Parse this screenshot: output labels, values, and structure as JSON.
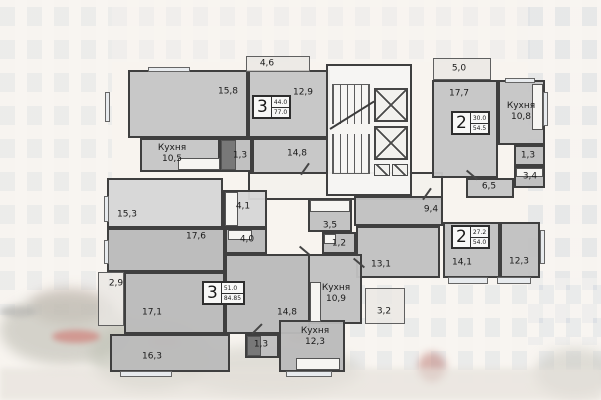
{
  "plan": {
    "wall_color": "#3f3f3f",
    "apartment_badges": [
      {
        "id": "apt-3room-44",
        "rooms": "3",
        "living_area": "44.0",
        "total_area": "77.0",
        "x": 252,
        "y": 95
      },
      {
        "id": "apt-2room-30",
        "rooms": "2",
        "living_area": "30.0",
        "total_area": "54.5",
        "x": 451,
        "y": 111
      },
      {
        "id": "apt-2room-27",
        "rooms": "2",
        "living_area": "27.2",
        "total_area": "54.0",
        "x": 451,
        "y": 225
      },
      {
        "id": "apt-3room-51",
        "rooms": "3",
        "living_area": "51.0",
        "total_area": "84.85",
        "x": 202,
        "y": 281
      }
    ],
    "rooms": [
      {
        "id": "room-15-8",
        "label": "15,8",
        "x": 128,
        "y": 70,
        "w": 120,
        "h": 68,
        "lx": 228,
        "ly": 92
      },
      {
        "id": "room-12-9",
        "label": "12,9",
        "x": 248,
        "y": 70,
        "w": 82,
        "h": 68,
        "lx": 303,
        "ly": 93
      },
      {
        "id": "balcony-4-6",
        "label": "4,6",
        "cls": "balcony",
        "x": 246,
        "y": 56,
        "w": 64,
        "h": 16,
        "lx": 267,
        "ly": 64
      },
      {
        "id": "kitchen-10-5",
        "label": "Кухня",
        "label2": "10,5",
        "x": 140,
        "y": 138,
        "w": 80,
        "h": 34,
        "lx": 172,
        "ly": 154
      },
      {
        "id": "wc-1-3-a",
        "label": "1,3",
        "x": 220,
        "y": 138,
        "w": 32,
        "h": 34,
        "fill": "rgba(190,190,190,0.96)",
        "lx": 240,
        "ly": 156
      },
      {
        "id": "hall-14-8-a",
        "label": "14,8",
        "x": 252,
        "y": 138,
        "w": 78,
        "h": 36,
        "lx": 297,
        "ly": 154
      },
      {
        "id": "room-15-3",
        "label": "15,3",
        "x": 107,
        "y": 178,
        "w": 116,
        "h": 50,
        "fill": "rgba(214,214,214,0.96)",
        "lx": 127,
        "ly": 215
      },
      {
        "id": "bath-4-1",
        "label": "4,1",
        "x": 223,
        "y": 190,
        "w": 44,
        "h": 38,
        "fill": "rgba(214,214,214,0.96)",
        "lx": 243,
        "ly": 207
      },
      {
        "id": "balcony-5-0",
        "label": "5,0",
        "cls": "balcony",
        "x": 433,
        "y": 58,
        "w": 58,
        "h": 22,
        "lx": 459,
        "ly": 69
      },
      {
        "id": "room-17-7",
        "label": "17,7",
        "x": 432,
        "y": 80,
        "w": 66,
        "h": 98,
        "lx": 459,
        "ly": 94
      },
      {
        "id": "kitchen-10-8",
        "label": "Кухня",
        "label2": "10,8",
        "x": 498,
        "y": 80,
        "w": 47,
        "h": 65,
        "lx": 521,
        "ly": 112
      },
      {
        "id": "wc-1-3-b",
        "label": "1,3",
        "x": 514,
        "y": 145,
        "w": 31,
        "h": 21,
        "fill": "rgba(190,190,190,0.96)",
        "lx": 528,
        "ly": 156
      },
      {
        "id": "bath-3-4",
        "label": "3,4",
        "x": 514,
        "y": 166,
        "w": 31,
        "h": 22,
        "fill": "rgba(190,190,190,0.96)",
        "lx": 530,
        "ly": 177
      },
      {
        "id": "hall-6-5",
        "label": "6,5",
        "x": 466,
        "y": 178,
        "w": 48,
        "h": 20,
        "lx": 489,
        "ly": 187
      },
      {
        "id": "hall-9-4",
        "label": "9,4",
        "x": 354,
        "y": 196,
        "w": 89,
        "h": 30,
        "fill": "rgba(193,193,193,0.96)",
        "lx": 431,
        "ly": 210
      },
      {
        "id": "bath-3-5",
        "label": "3,5",
        "x": 308,
        "y": 198,
        "w": 44,
        "h": 34,
        "fill": "rgba(193,193,193,0.96)",
        "lx": 330,
        "ly": 226
      },
      {
        "id": "wc-1-2",
        "label": "1,2",
        "x": 322,
        "y": 232,
        "w": 34,
        "h": 22,
        "fill": "rgba(190,190,190,0.96)",
        "lx": 339,
        "ly": 244
      },
      {
        "id": "room-13-1",
        "label": "13,1",
        "x": 356,
        "y": 226,
        "w": 84,
        "h": 52,
        "fill": "rgba(193,193,193,0.96)",
        "lx": 381,
        "ly": 265
      },
      {
        "id": "room-14-1",
        "label": "14,1",
        "x": 443,
        "y": 222,
        "w": 57,
        "h": 56,
        "fill": "rgba(193,193,193,0.96)",
        "lx": 462,
        "ly": 263
      },
      {
        "id": "room-12-3",
        "label": "12,3",
        "x": 500,
        "y": 222,
        "w": 40,
        "h": 56,
        "fill": "rgba(193,193,193,0.96)",
        "lx": 519,
        "ly": 262
      },
      {
        "id": "kitchen-10-9",
        "label": "Кухня",
        "label2": "10,9",
        "x": 308,
        "y": 254,
        "w": 54,
        "h": 70,
        "fill": "rgba(193,193,193,0.96)",
        "lx": 336,
        "ly": 294
      },
      {
        "id": "balcony-3-2",
        "label": "3,2",
        "cls": "balcony",
        "x": 365,
        "y": 288,
        "w": 40,
        "h": 36,
        "lx": 384,
        "ly": 312
      },
      {
        "id": "room-17-6",
        "label": "17,6",
        "x": 107,
        "y": 228,
        "w": 118,
        "h": 44,
        "fill": "rgba(186,186,186,0.96)",
        "lx": 196,
        "ly": 237
      },
      {
        "id": "bath-4-0",
        "label": "4,0",
        "x": 225,
        "y": 228,
        "w": 42,
        "h": 26,
        "fill": "rgba(186,186,186,0.96)",
        "lx": 247,
        "ly": 240
      },
      {
        "id": "hall-14-8-b",
        "label": "14,8",
        "x": 225,
        "y": 254,
        "w": 85,
        "h": 80,
        "fill": "rgba(186,186,186,0.96)",
        "lx": 287,
        "ly": 313
      },
      {
        "id": "room-17-1",
        "label": "17,1",
        "x": 124,
        "y": 272,
        "w": 101,
        "h": 62,
        "fill": "rgba(186,186,186,0.96)",
        "lx": 152,
        "ly": 313
      },
      {
        "id": "room-16-3",
        "label": "16,3",
        "x": 110,
        "y": 334,
        "w": 120,
        "h": 38,
        "fill": "rgba(186,186,186,0.96)",
        "lx": 152,
        "ly": 357
      },
      {
        "id": "wc-1-3-c",
        "label": "1,3",
        "x": 245,
        "y": 334,
        "w": 34,
        "h": 24,
        "fill": "rgba(190,190,190,0.96)",
        "lx": 261,
        "ly": 345
      },
      {
        "id": "kitchen-12-3",
        "label": "Кухня",
        "label2": "12,3",
        "x": 279,
        "y": 320,
        "w": 66,
        "h": 52,
        "fill": "rgba(186,186,186,0.96)",
        "lx": 315,
        "ly": 337
      },
      {
        "id": "balcony-2-9",
        "label": "2,9",
        "cls": "balcony",
        "x": 98,
        "y": 272,
        "w": 26,
        "h": 54,
        "lx": 116,
        "ly": 284
      }
    ]
  }
}
